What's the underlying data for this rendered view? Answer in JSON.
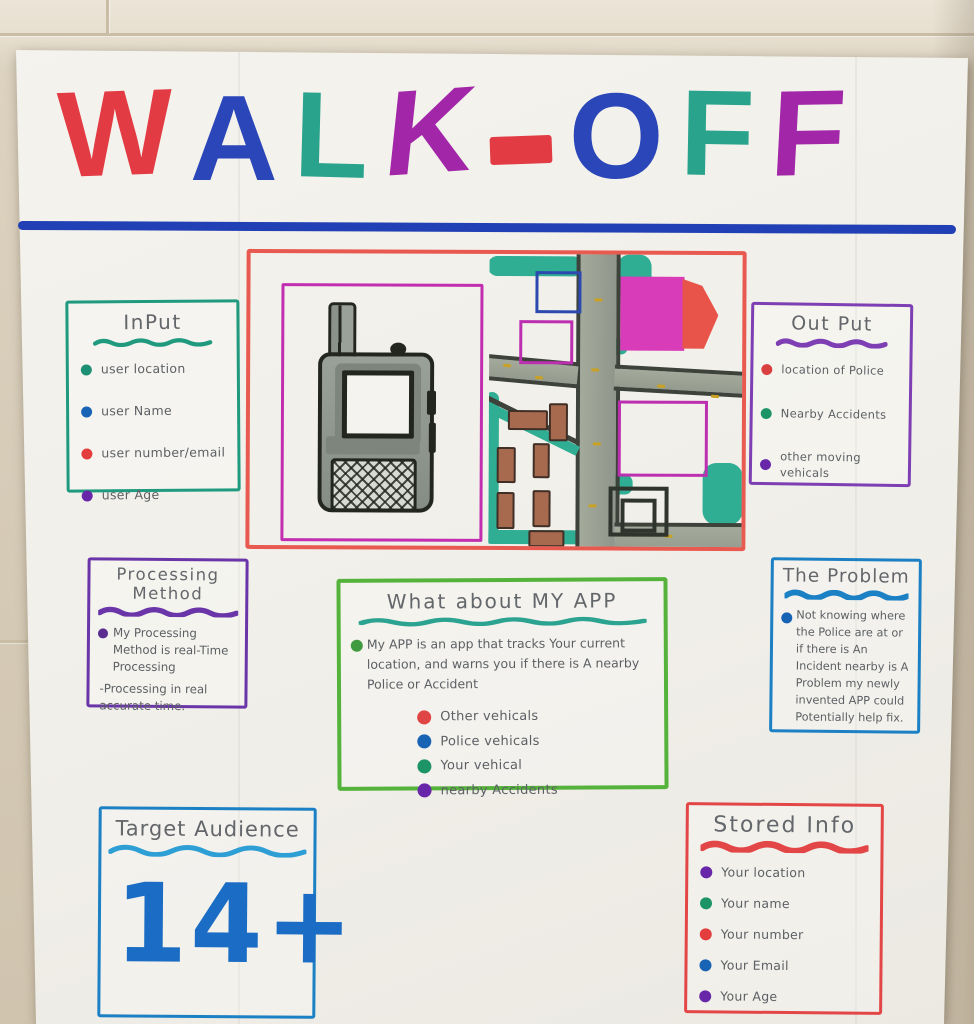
{
  "title": {
    "letters": [
      {
        "char": "W",
        "color": "#e23b43"
      },
      {
        "char": "A",
        "color": "#2a46b8"
      },
      {
        "char": "L",
        "color": "#2aa38c"
      },
      {
        "char": "K",
        "color": "#a226a8"
      },
      {
        "char": "-",
        "color": "#e23b43"
      },
      {
        "char": "O",
        "color": "#2a46b8"
      },
      {
        "char": "F",
        "color": "#2aa38c"
      },
      {
        "char": "F",
        "color": "#a226a8"
      }
    ],
    "rule_color": "#2140b5"
  },
  "boxes": {
    "input": {
      "title": "InPut",
      "border_color": "#1f9a7e",
      "underline_color": "#1f9a7e",
      "items": [
        {
          "dot": "#1d8f74",
          "label": "user location"
        },
        {
          "dot": "#1863b3",
          "label": "user Name"
        },
        {
          "dot": "#e33d3d",
          "label": "user number/email"
        },
        {
          "dot": "#6727a8",
          "label": "user Age"
        }
      ]
    },
    "output": {
      "title": "Out Put",
      "border_color": "#7d3fb3",
      "underline_color": "#7d3fb3",
      "items": [
        {
          "dot": "#d94040",
          "label": "location of Police"
        },
        {
          "dot": "#1d9468",
          "label": "Nearby Accidents"
        },
        {
          "dot": "#6727a8",
          "label": "other moving vehicals"
        }
      ]
    },
    "processing": {
      "title": "Processing Method",
      "border_color": "#6a35a8",
      "underline_color": "#6a35a8",
      "bullet_dot": "#5c2d91",
      "bullet": "My Processing Method is real-Time Processing",
      "note": "-Processing in real accurate time."
    },
    "about": {
      "title": "What about MY APP",
      "border_color": "#55b33c",
      "underline_color": "#2ba390",
      "bullet_dot": "#3f9a40",
      "paragraph": "My APP is an app that tracks Your current location, and warns you if there is A nearby Police or Accident",
      "legend": [
        {
          "dot": "#e04545",
          "label": "Other vehicals"
        },
        {
          "dot": "#1863b3",
          "label": "Police vehicals"
        },
        {
          "dot": "#1d9468",
          "label": "Your vehical"
        },
        {
          "dot": "#6727a8",
          "label": "nearby Accidents"
        }
      ]
    },
    "problem": {
      "title": "The Problem",
      "border_color": "#1b80c4",
      "underline_color": "#1b80c4",
      "bullet_dot": "#1863b3",
      "text": "Not knowing where the Police are at or if there is An Incident nearby is A Problem my newly invented APP could Potentially help fix."
    },
    "target": {
      "title": "Target Audience",
      "border_color": "#1b80c4",
      "underline_color": "#2e9fd4",
      "value": "14+",
      "value_color": "#1b6cc4"
    },
    "stored": {
      "title": "Stored Info",
      "border_color": "#e34646",
      "underline_color": "#e34646",
      "items": [
        {
          "dot": "#6727a8",
          "label": "Your location"
        },
        {
          "dot": "#1d9468",
          "label": "Your name"
        },
        {
          "dot": "#e33d3d",
          "label": "Your number"
        },
        {
          "dot": "#1863b3",
          "label": "Your Email"
        },
        {
          "dot": "#6727a8",
          "label": "Your Age"
        }
      ]
    }
  },
  "illustration": {
    "panel_border_color": "#e85a50",
    "device_frame_color": "#c12fb0",
    "left": "walkie-talkie-drawing",
    "right": "street-map-drawing",
    "map_colors": {
      "road": "#9da394",
      "road_edge": "#3d423b",
      "bush": "#2fae93",
      "building_pink": "#d93cb8",
      "building_red": "#e8544a",
      "outline_blue": "#2b49ae",
      "outline_magenta": "#bc2fb0",
      "car_brown": "#a86a4e",
      "lane_yellow": "#c9a224",
      "dark_structure": "#2f342d"
    }
  }
}
